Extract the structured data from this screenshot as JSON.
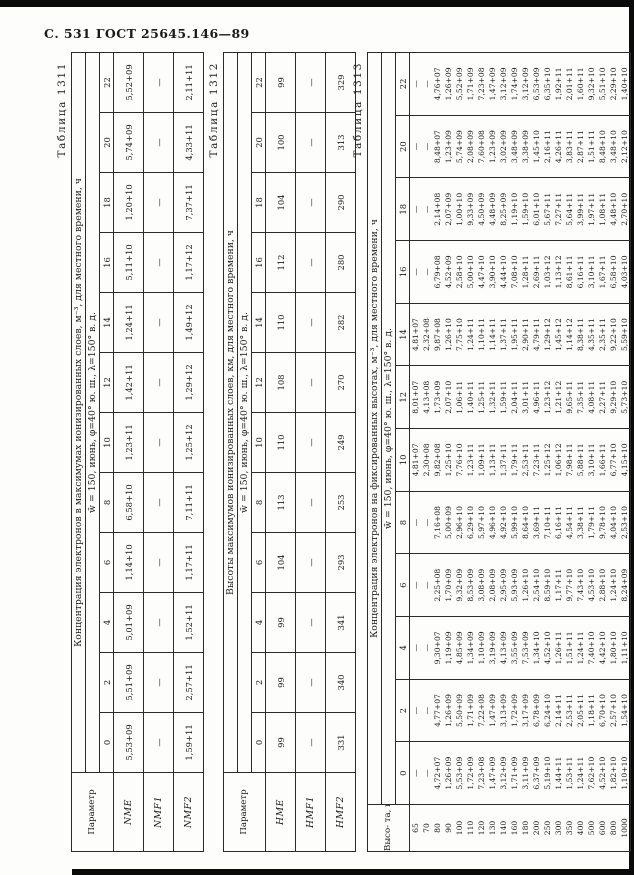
{
  "page": {
    "header": "С. 531 ГОСТ 25645.146—89"
  },
  "tables": [
    {
      "caption": "Таблица 1311",
      "param_header": "Параметр",
      "title": "Концентрация электронов в максимумах ионизированных слоев, м⁻³, для местного времени, ч",
      "regime": "w̄ = 150, июнь, φ=40° ю. ш., λ=150° в. д.",
      "times": [
        "0",
        "2",
        "4",
        "6",
        "8",
        "10",
        "12",
        "14",
        "16",
        "18",
        "20",
        "22"
      ],
      "rows": [
        {
          "label": "NME",
          "values": [
            "5,53+09",
            "5,51+09",
            "5,01+09",
            "1,14+10",
            "6,58+10",
            "1,23+11",
            "1,42+11",
            "1,24+11",
            "5,11+10",
            "1,20+10",
            "5,74+09",
            "5,52+09"
          ]
        },
        {
          "label": "NMF1",
          "values": [
            "—",
            "—",
            "—",
            "—",
            "—",
            "—",
            "—",
            "—",
            "—",
            "—",
            "—",
            "—"
          ]
        },
        {
          "label": "NMF2",
          "values": [
            "1,59+11",
            "2,57+11",
            "1,52+11",
            "1,17+11",
            "7,11+11",
            "1,25+12",
            "1,29+12",
            "1,49+12",
            "1,17+12",
            "7,37+11",
            "4,33+11",
            "2,11+11"
          ]
        }
      ]
    },
    {
      "caption": "Таблица 1312",
      "param_header": "Параметр",
      "title": "Высоты максимумов ионизированных слоев, км, для местного времени, ч",
      "regime": "w̄ = 150, июнь, φ=40° ю. ш., λ=150° в. д.",
      "times": [
        "0",
        "2",
        "4",
        "6",
        "8",
        "10",
        "12",
        "14",
        "16",
        "18",
        "20",
        "22"
      ],
      "rows": [
        {
          "label": "HME",
          "values": [
            "99",
            "99",
            "99",
            "104",
            "113",
            "110",
            "108",
            "110",
            "112",
            "104",
            "100",
            "99"
          ]
        },
        {
          "label": "HMF1",
          "values": [
            "—",
            "—",
            "—",
            "—",
            "—",
            "—",
            "—",
            "—",
            "—",
            "—",
            "—",
            "—"
          ]
        },
        {
          "label": "HMF2",
          "values": [
            "331",
            "340",
            "341",
            "293",
            "253",
            "249",
            "270",
            "282",
            "280",
            "290",
            "313",
            "329"
          ]
        }
      ]
    },
    {
      "caption": "Таблица 1313",
      "param_header": "Высо-\nта, км",
      "title": "Концентрация электронов на фиксированных высотах, м⁻³, для местного времени, ч",
      "regime": "w̄ = 150, июнь, φ=40° ю. ш., λ=150° в. д.",
      "times": [
        "0",
        "2",
        "4",
        "6",
        "8",
        "10",
        "12",
        "14",
        "16",
        "18",
        "20",
        "22"
      ],
      "rows": [
        {
          "label": "65",
          "values": [
            "—",
            "—",
            "—",
            "—",
            "—",
            "4,81+07",
            "8,01+07",
            "4,81+07",
            "—",
            "—",
            "—",
            "—"
          ]
        },
        {
          "label": "70",
          "values": [
            "—",
            "—",
            "—",
            "—",
            "—",
            "2,30+08",
            "4,13+08",
            "2,32+08",
            "—",
            "—",
            "—",
            "—"
          ]
        },
        {
          "label": "80",
          "values": [
            "4,72+07",
            "4,77+07",
            "9,30+07",
            "2,25+08",
            "7,16+08",
            "9,82+08",
            "1,73+09",
            "9,87+08",
            "6,79+08",
            "2,14+08",
            "8,48+07",
            "4,76+07"
          ]
        },
        {
          "label": "90",
          "values": [
            "1,26+09",
            "1,26+09",
            "1,19+09",
            "1,70+09",
            "5,00+09",
            "1,25+10",
            "2,07+10",
            "1,26+10",
            "4,52+09",
            "2,07+09",
            "1,23+09",
            "1,26+09"
          ]
        },
        {
          "label": "100",
          "values": [
            "5,53+09",
            "5,50+09",
            "4,85+09",
            "9,32+09",
            "2,96+10",
            "7,76+10",
            "1,06+11",
            "7,75+10",
            "2,58+10",
            "1,00+10",
            "5,74+09",
            "5,52+09"
          ]
        },
        {
          "label": "110",
          "values": [
            "1,72+09",
            "1,71+09",
            "1,34+09",
            "8,53+09",
            "6,29+10",
            "1,23+11",
            "1,40+11",
            "1,24+11",
            "5,00+10",
            "9,33+09",
            "2,08+09",
            "1,71+09"
          ]
        },
        {
          "label": "120",
          "values": [
            "7,23+08",
            "7,22+08",
            "1,10+09",
            "3,08+09",
            "5,97+10",
            "1,09+11",
            "1,25+11",
            "1,10+11",
            "4,47+10",
            "4,50+09",
            "7,60+08",
            "7,23+08"
          ]
        },
        {
          "label": "130",
          "values": [
            "1,47+09",
            "1,47+09",
            "3,19+09",
            "2,08+09",
            "4,96+10",
            "1,13+11",
            "1,32+11",
            "1,14+11",
            "3,90+10",
            "4,48+09",
            "1,23+09",
            "1,47+09"
          ]
        },
        {
          "label": "140",
          "values": [
            "3,12+09",
            "3,13+09",
            "4,13+09",
            "2,95+09",
            "4,92+10",
            "1,37+11",
            "1,59+11",
            "1,37+11",
            "4,44+10",
            "8,25+09",
            "3,02+09",
            "3,12+09"
          ]
        },
        {
          "label": "160",
          "values": [
            "1,71+09",
            "1,72+09",
            "3,55+09",
            "5,93+09",
            "5,99+10",
            "1,79+11",
            "2,04+11",
            "1,95+11",
            "7,08+10",
            "1,19+10",
            "3,48+09",
            "1,74+09"
          ]
        },
        {
          "label": "180",
          "values": [
            "3,11+09",
            "3,17+09",
            "7,53+09",
            "1,26+10",
            "8,64+10",
            "2,53+11",
            "3,01+11",
            "2,90+11",
            "1,28+11",
            "1,59+10",
            "3,38+09",
            "3,12+09"
          ]
        },
        {
          "label": "200",
          "values": [
            "6,37+09",
            "6,78+09",
            "1,34+10",
            "2,54+10",
            "3,69+11",
            "7,23+11",
            "4,96+11",
            "4,79+11",
            "2,69+11",
            "6,01+10",
            "1,45+10",
            "6,53+09"
          ]
        },
        {
          "label": "250",
          "values": [
            "5,19+10",
            "6,24+10",
            "4,52+10",
            "8,59+10",
            "7,10+11",
            "1,25+12",
            "1,23+12",
            "1,29+12",
            "1,03+12",
            "5,67+11",
            "2,16+11",
            "6,35+10"
          ]
        },
        {
          "label": "300",
          "values": [
            "1,44+11",
            "2,14+11",
            "1,26+11",
            "1,17+11",
            "6,16+11",
            "1,06+12",
            "1,21+12",
            "1,45+12",
            "1,13+12",
            "7,27+11",
            "4,26+11",
            "1,92+11"
          ]
        },
        {
          "label": "350",
          "values": [
            "1,53+11",
            "2,53+11",
            "1,51+11",
            "9,77+10",
            "4,54+11",
            "7,98+11",
            "9,65+11",
            "1,14+12",
            "8,61+11",
            "5,64+11",
            "3,83+11",
            "2,01+11"
          ]
        },
        {
          "label": "400",
          "values": [
            "1,24+11",
            "2,05+11",
            "1,24+11",
            "7,43+10",
            "3,38+11",
            "5,88+11",
            "7,35+11",
            "8,38+11",
            "6,16+11",
            "3,99+11",
            "2,87+11",
            "1,60+11"
          ]
        },
        {
          "label": "500",
          "values": [
            "7,62+10",
            "1,18+11",
            "7,40+10",
            "4,53+10",
            "1,79+11",
            "3,10+11",
            "4,08+11",
            "4,35+11",
            "3,10+11",
            "1,97+11",
            "1,51+11",
            "9,32+10"
          ]
        },
        {
          "label": "600",
          "values": [
            "4,52+10",
            "6,70+10",
            "4,42+10",
            "2,88+10",
            "9,78+10",
            "1,66+11",
            "2,27+11",
            "2,35+11",
            "1,67+11",
            "1,08+11",
            "8,48+10",
            "5,51+10"
          ]
        },
        {
          "label": "800",
          "values": [
            "1,82+10",
            "2,57+10",
            "1,80+10",
            "1,24+10",
            "4,04+10",
            "6,77+10",
            "9,29+10",
            "9,22+10",
            "6,58+10",
            "4,48+10",
            "3,48+10",
            "2,29+10"
          ]
        },
        {
          "label": "1000",
          "values": [
            "1,10+10",
            "1,54+10",
            "1,11+10",
            "8,24+09",
            "2,53+10",
            "4,15+10",
            "5,73+10",
            "5,59+10",
            "4,03+10",
            "2,70+10",
            "2,12+10",
            "1,40+10"
          ]
        }
      ]
    }
  ]
}
